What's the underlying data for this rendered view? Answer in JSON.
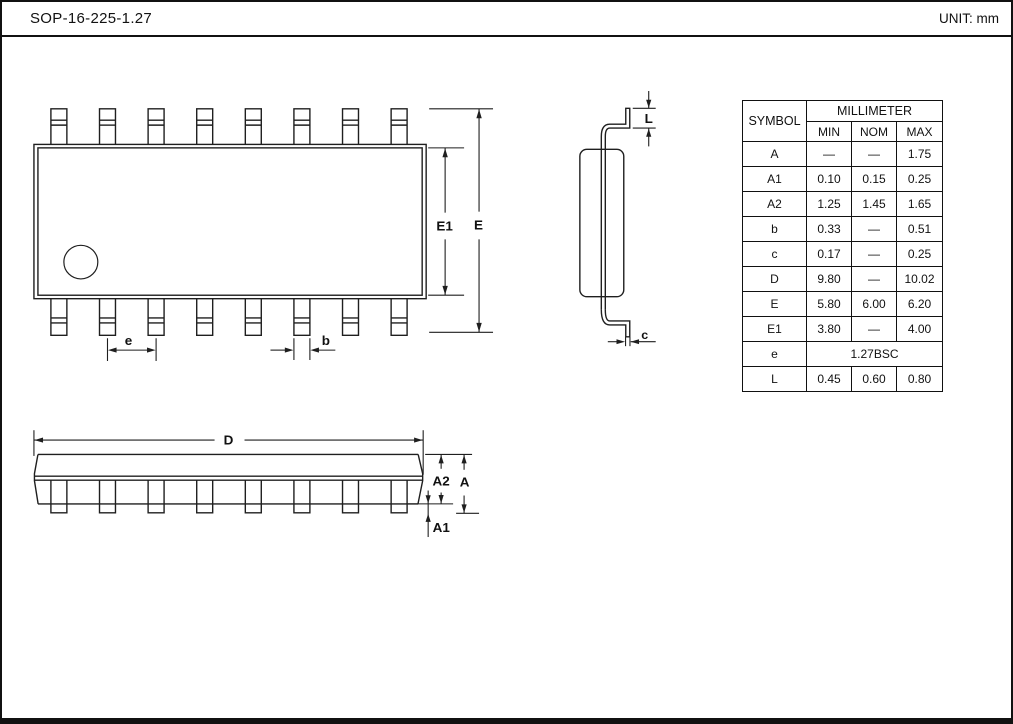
{
  "header": {
    "title": "SOP-16-225-1.27",
    "unit_label": "UNIT: mm"
  },
  "colors": {
    "line": "#1f1f1f",
    "background": "#ffffff"
  },
  "drawing": {
    "labels": {
      "D": "D",
      "E": "E",
      "E1": "E1",
      "e": "e",
      "b": "b",
      "c": "c",
      "L": "L",
      "A": "A",
      "A1": "A1",
      "A2": "A2"
    }
  },
  "table": {
    "symbol_header": "SYMBOL",
    "unit_header": "MILLIMETER",
    "col_headers": [
      "MIN",
      "NOM",
      "MAX"
    ],
    "rows": [
      {
        "symbol": "A",
        "min": "—",
        "nom": "—",
        "max": "1.75"
      },
      {
        "symbol": "A1",
        "min": "0.10",
        "nom": "0.15",
        "max": "0.25"
      },
      {
        "symbol": "A2",
        "min": "1.25",
        "nom": "1.45",
        "max": "1.65"
      },
      {
        "symbol": "b",
        "min": "0.33",
        "nom": "—",
        "max": "0.51"
      },
      {
        "symbol": "c",
        "min": "0.17",
        "nom": "—",
        "max": "0.25"
      },
      {
        "symbol": "D",
        "min": "9.80",
        "nom": "—",
        "max": "10.02"
      },
      {
        "symbol": "E",
        "min": "5.80",
        "nom": "6.00",
        "max": "6.20"
      },
      {
        "symbol": "E1",
        "min": "3.80",
        "nom": "—",
        "max": "4.00"
      },
      {
        "symbol": "e",
        "span": "1.27BSC"
      },
      {
        "symbol": "L",
        "min": "0.45",
        "nom": "0.60",
        "max": "0.80"
      }
    ]
  }
}
